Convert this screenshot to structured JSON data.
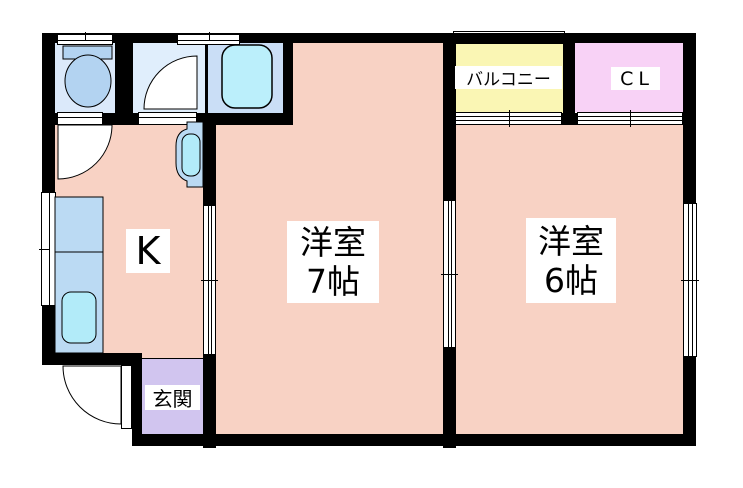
{
  "plan": {
    "kitchen": {
      "label": "K"
    },
    "western_room_7": {
      "name": "洋室",
      "size": "7帖"
    },
    "western_room_6": {
      "name": "洋室",
      "size": "6帖"
    },
    "balcony": {
      "label": "バルコニー"
    },
    "closet": {
      "label": "CL"
    },
    "entrance": {
      "label": "玄関"
    }
  },
  "colors": {
    "room_pink": "#f8d2c4",
    "entrance_purple": "#d1c5ef",
    "balcony_yellow": "#faf6b4",
    "closet_pink": "#f8d2f6",
    "toilet_room_blue": "#dbe9fa",
    "washroom_blue": "#e0eefc",
    "bathroom_blue": "#cadef6",
    "fixture_blue": "#b3d3f1",
    "counter_blue": "#bbdaf3",
    "tub_cyan": "#bbeffb",
    "sink_cyan": "#b2ebf9",
    "wall_black": "#000000"
  }
}
